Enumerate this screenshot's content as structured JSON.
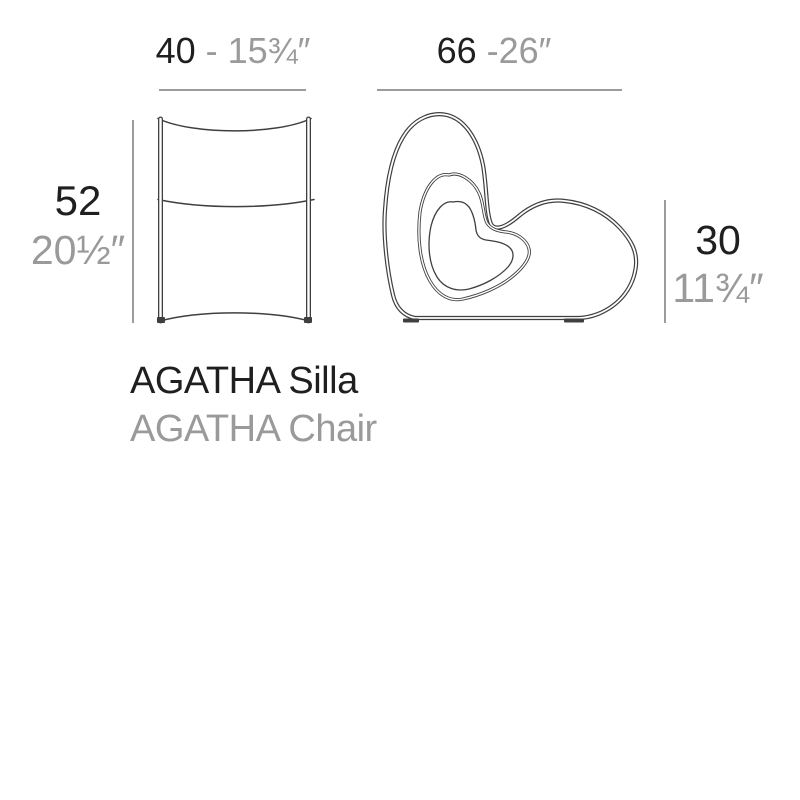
{
  "product": {
    "name_es": "AGATHA Silla",
    "name_en": "AGATHA Chair"
  },
  "dimensions": {
    "front_width": {
      "cm": "40",
      "inches": "- 15¾″"
    },
    "side_width": {
      "cm": "66",
      "inches": "-26″"
    },
    "front_height": {
      "cm": "52",
      "inches": "20½″"
    },
    "side_height": {
      "cm": "30",
      "inches": "11¾″"
    }
  },
  "colors": {
    "background": "#ffffff",
    "text_dark": "#1f1f1f",
    "text_gray": "#9a9a9a",
    "drawing_line": "#3f3f3f",
    "dimension_line": "#9c9c9c"
  }
}
